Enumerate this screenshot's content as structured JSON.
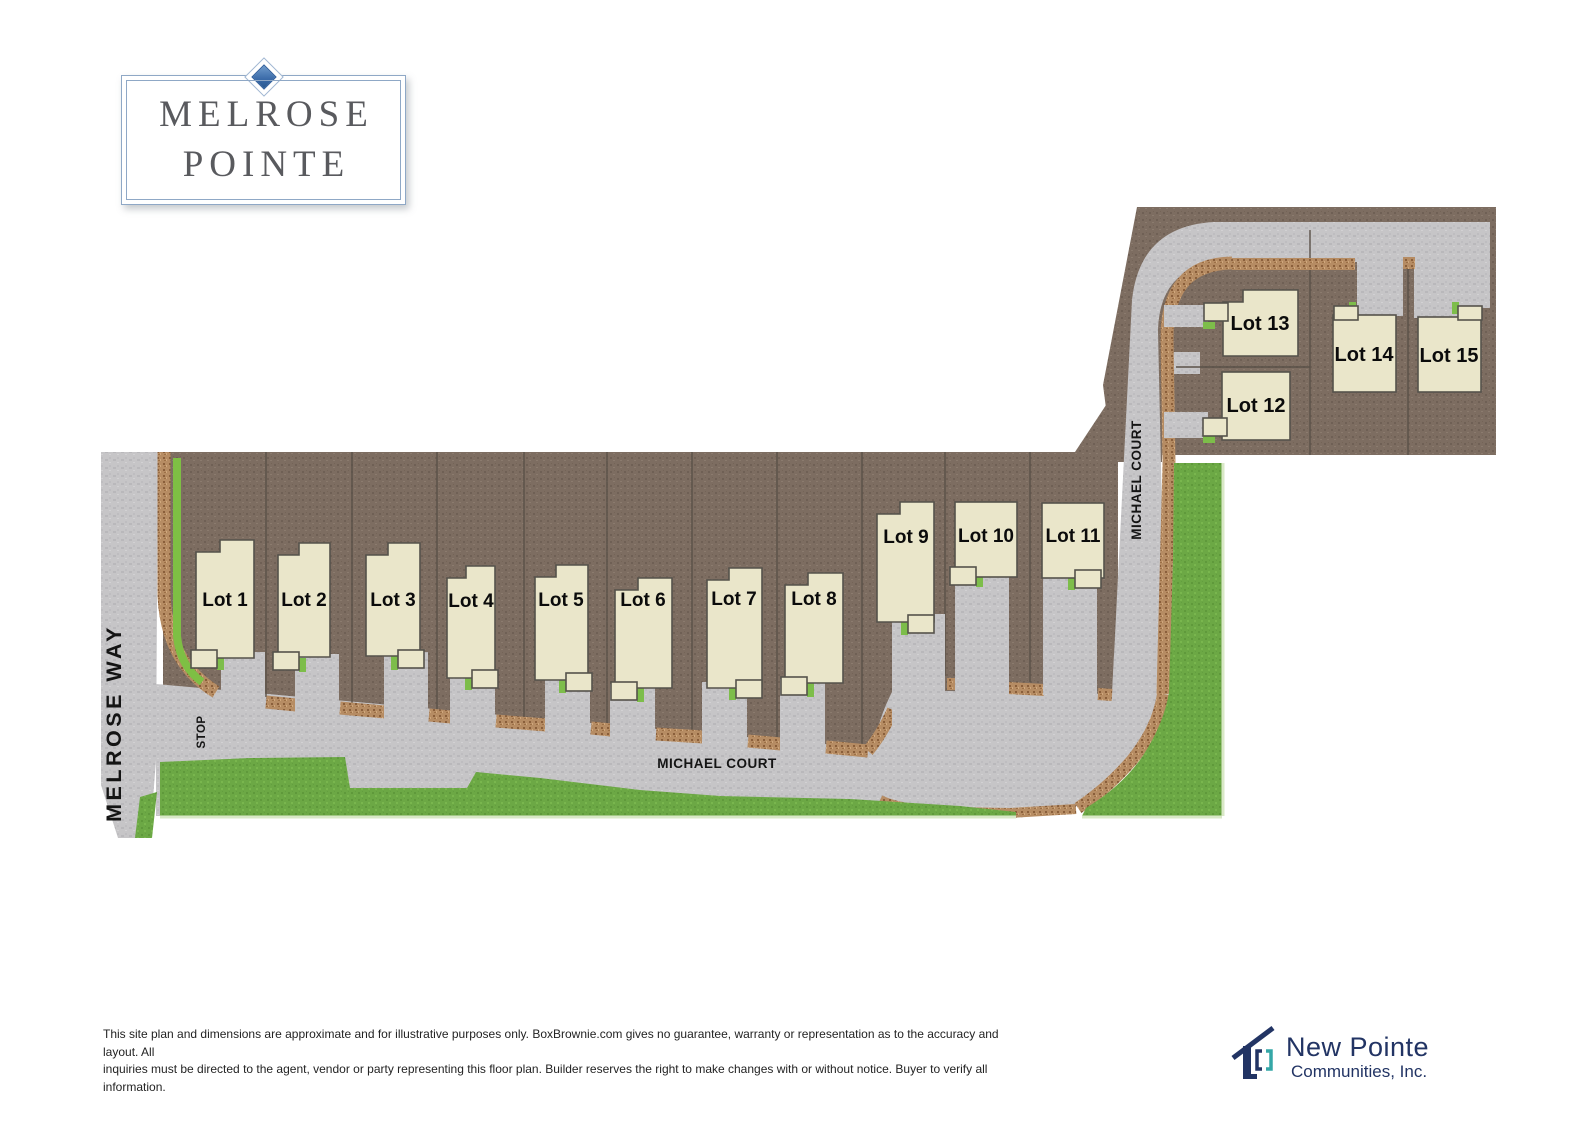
{
  "logo": {
    "line1": "MELROSE",
    "line2": "POINTE"
  },
  "site": {
    "lots": [
      {
        "label": "Lot 1"
      },
      {
        "label": "Lot 2"
      },
      {
        "label": "Lot 3"
      },
      {
        "label": "Lot 4"
      },
      {
        "label": "Lot 5"
      },
      {
        "label": "Lot 6"
      },
      {
        "label": "Lot 7"
      },
      {
        "label": "Lot 8"
      },
      {
        "label": "Lot 9"
      },
      {
        "label": "Lot 10"
      },
      {
        "label": "Lot 11"
      },
      {
        "label": "Lot 12"
      },
      {
        "label": "Lot 13"
      },
      {
        "label": "Lot 14"
      },
      {
        "label": "Lot 15"
      }
    ],
    "streets": {
      "melrose_way": "MELROSE WAY",
      "michael_court": "MICHAEL COURT",
      "michael_court_vertical": "MICHAEL COURT",
      "stop": "STOP"
    }
  },
  "footer": {
    "disclaimer_line1": "This site plan and dimensions are approximate and for illustrative purposes only. BoxBrownie.com gives no guarantee, warranty or representation as to the accuracy and layout. All",
    "disclaimer_line2": "inquiries must be directed to the agent, vendor or party representing this floor plan. Builder reserves the right to make changes with or without notice. Buyer to verify all information."
  },
  "brand": {
    "line1": "New Pointe",
    "line2": "Communities, Inc."
  },
  "colors": {
    "lot_field": "#7d6d61",
    "road": "#c6c5c7",
    "gravel": "#b68c63",
    "grass": "#6ca845",
    "building": "#eae6ca",
    "logo_blue": "#3a6aa8",
    "logo_border_blue": "#8fa8c6",
    "brand_navy": "#223464",
    "brand_teal": "#35a7a7"
  }
}
